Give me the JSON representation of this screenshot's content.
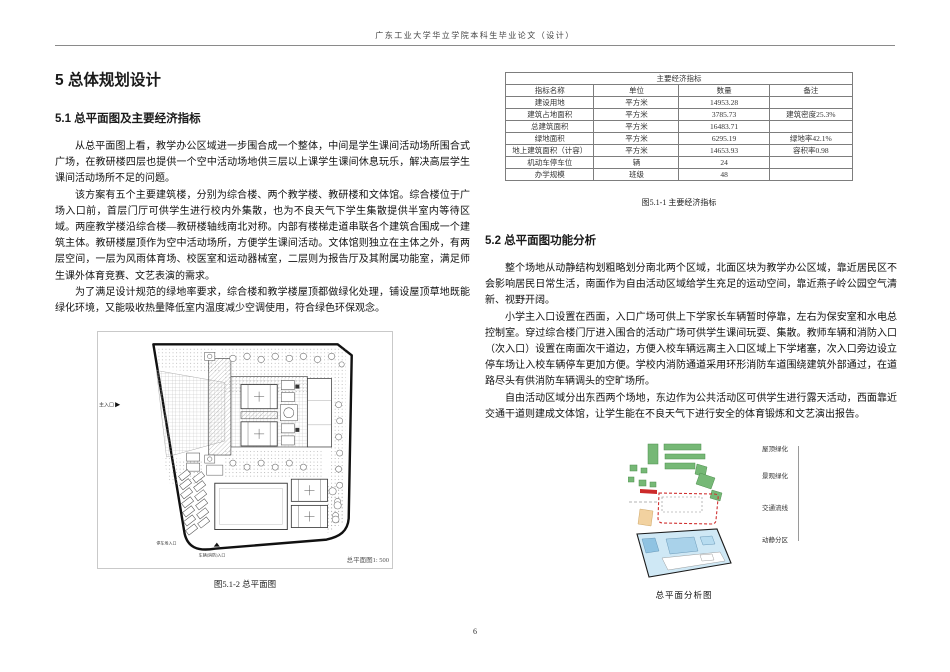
{
  "page": {
    "header_title": "广东工业大学华立学院本科生毕业论文（设计）",
    "page_number": "6"
  },
  "chapter": {
    "title": "5 总体规划设计"
  },
  "section_51": {
    "heading": "5.1 总平面图及主要经济指标",
    "paragraphs": [
      "从总平面图上看，教学办公区域进一步围合成一个整体，中间是学生课间活动场所围合式广场，在教研楼四层也提供一个空中活动场地供三层以上课学生课间休息玩乐，解决高层学生课间活动场所不足的问题。",
      "该方案有五个主要建筑楼，分别为综合楼、两个教学楼、教研楼和文体馆。综合楼位于广场入口前，首层门厅可供学生进行校内外集散，也为不良天气下学生集散提供半室内等待区域。两座教学楼沿综合楼—教研楼轴线南北对称。内部有楼梯走道串联各个建筑合围成一个建筑主体。教研楼屋顶作为空中活动场所，方便学生课间活动。文体馆则独立在主体之外，有两层空间，一层为风雨体育场、校医室和运动器械室，二层则为报告厅及其附属功能室，满足师生课外体育竞赛、文艺表演的需求。",
      "为了满足设计规范的绿地率要求，综合楼和教学楼屋顶都做绿化处理，铺设屋顶草地既能绿化环境，又能吸收热量降低室内温度减少空调使用，符合绿色环保观念。"
    ],
    "figure": {
      "scale_note": "总平面图1: 500",
      "caption": "图5.1-2 总平面图",
      "labels": {
        "main_entrance": "主入口",
        "parking_entrance": "停车场入口",
        "vehicle_fire_entrance": "车辆(消防)入口"
      }
    }
  },
  "economic_table": {
    "title": "主要经济指标",
    "headers": [
      "指标名称",
      "单位",
      "数量",
      "备注"
    ],
    "rows": [
      [
        "建设用地",
        "平方米",
        "14953.28",
        ""
      ],
      [
        "建筑占地面积",
        "平方米",
        "3785.73",
        "建筑密度25.3%"
      ],
      [
        "总建筑面积",
        "平方米",
        "16483.71",
        ""
      ],
      [
        "绿地面积",
        "平方米",
        "6295.19",
        "绿地率42.1%"
      ],
      [
        "地上建筑面积（计容）",
        "平方米",
        "14653.93",
        "容积率0.98"
      ],
      [
        "机动车停车位",
        "辆",
        "24",
        ""
      ],
      [
        "办学规模",
        "班级",
        "48",
        ""
      ]
    ],
    "caption": "图5.1-1 主要经济指标"
  },
  "section_52": {
    "heading": "5.2 总平面图功能分析",
    "paragraphs": [
      "整个场地从动静结构划粗略划分南北两个区域，北面区块为教学办公区域，靠近居民区不会影响居民日常生活，南面作为自由活动区域给学生充足的运动空间，靠近燕子岭公园空气清新、视野开阔。",
      "小学主入口设置在西面，入口广场可供上下学家长车辆暂时停靠，左右为保安室和水电总控制室。穿过综合楼门厅进入围合的活动广场可供学生课间玩耍、集散。教师车辆和消防入口（次入口）设置在南面次干道边，方便入校车辆远离主入口区域上下学堵塞，次入口旁边设立停车场让入校车辆停车更加方便。学校内消防通道采用环形消防车道围绕建筑外部通过，在道路尽头有供消防车辆调头的空旷场所。",
      "自由活动区域分出东西两个场地，东边作为公共活动区可供学生进行露天活动，西面靠近交通干道则建成文体馆，让学生能在不良天气下进行安全的体育锻炼和文艺演出报告。"
    ],
    "diagram": {
      "layer_labels": [
        "屋顶绿化",
        "景观绿化",
        "交通流线",
        "动静分区"
      ],
      "caption": "总平面分析图",
      "colors": {
        "green": "#76b876",
        "red": "#cc2a2a",
        "tan": "#f2d2a0",
        "blue": "#cfe8f5"
      }
    }
  }
}
